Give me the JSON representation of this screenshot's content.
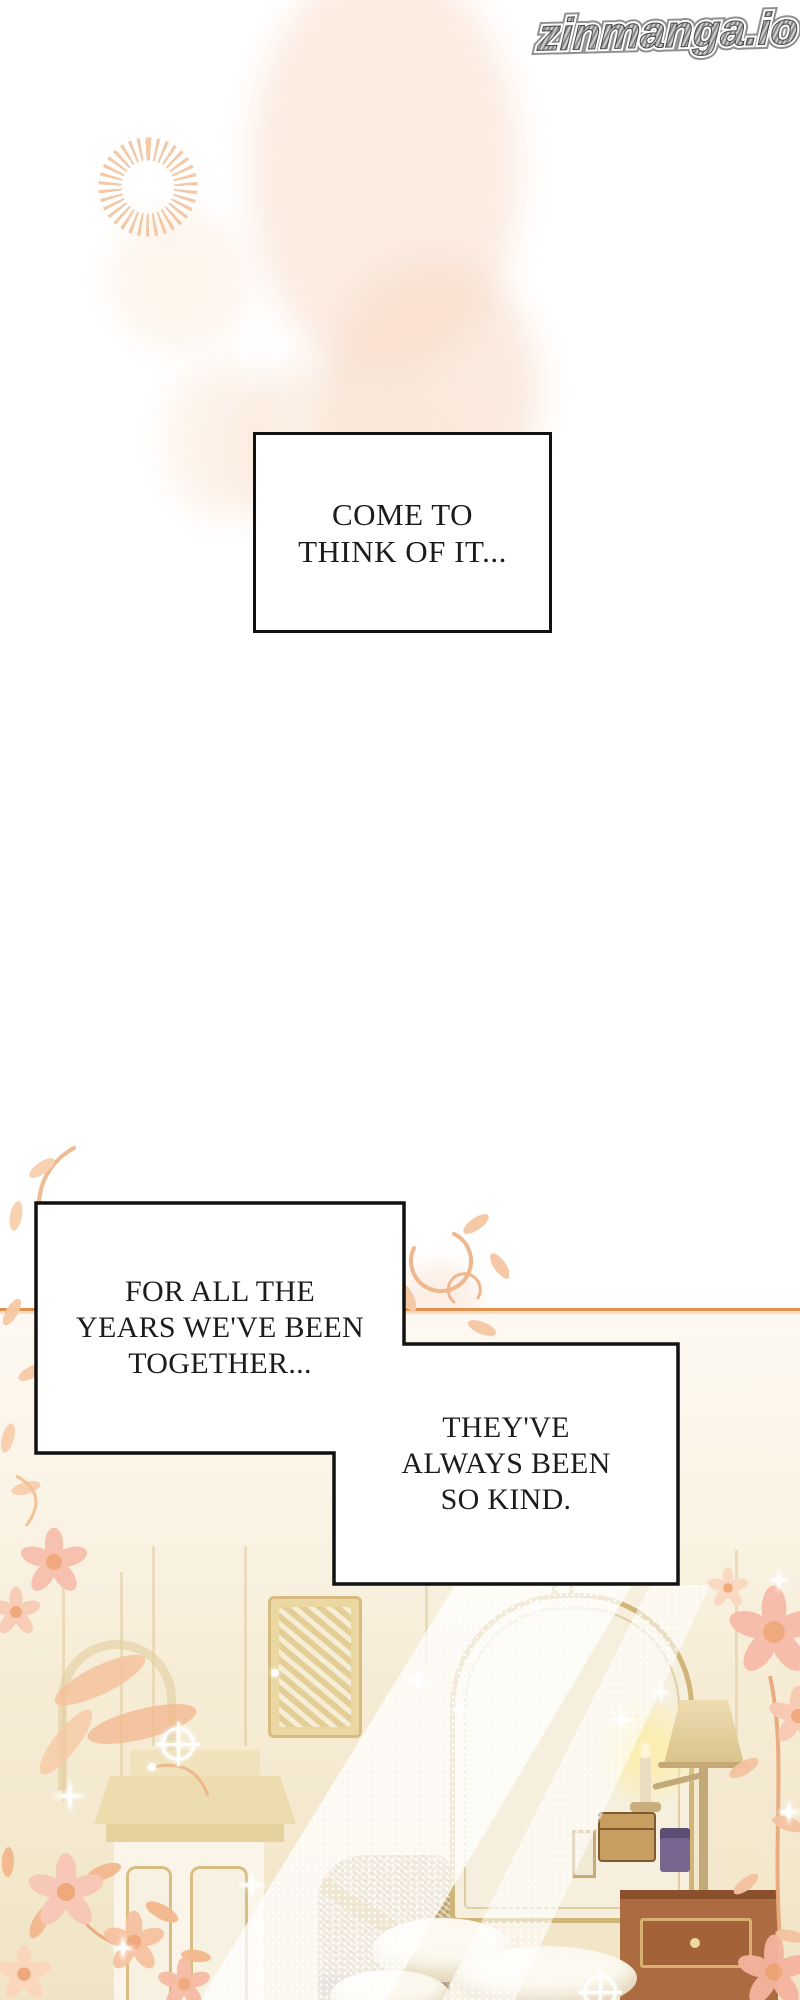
{
  "watermark": {
    "text": "zinmanga.io"
  },
  "bubbles": [
    {
      "name": "bubble-1",
      "lines": [
        "COME TO",
        "THINK OF IT..."
      ]
    },
    {
      "name": "bubble-2",
      "lines": [
        "FOR ALL THE",
        "YEARS WE'VE BEEN",
        "TOGETHER..."
      ]
    },
    {
      "name": "bubble-3",
      "lines": [
        "THEY'VE",
        "ALWAYS BEEN",
        "SO KIND."
      ]
    }
  ],
  "palette": {
    "page_background": "#ffffff",
    "blush_peach": "#f8ddc8",
    "sunburst_peach": "#f2c098",
    "flora_peach": "#f7c8a6",
    "flora_pink": "#f8c4b4",
    "vine_stroke": "#eeb78d",
    "wall_line_orange": "#e0914f",
    "wall_cream": "#f3e7cc",
    "gold_trim": "#d2b97e",
    "desk_brown": "#ac6b40",
    "lamp_glow": "#fbeeaf",
    "bubble_fill": "#ffffff",
    "bubble_border": "#111111",
    "bubble_text": "#1c1c1c",
    "watermark_gray": "#8d8d8d"
  }
}
